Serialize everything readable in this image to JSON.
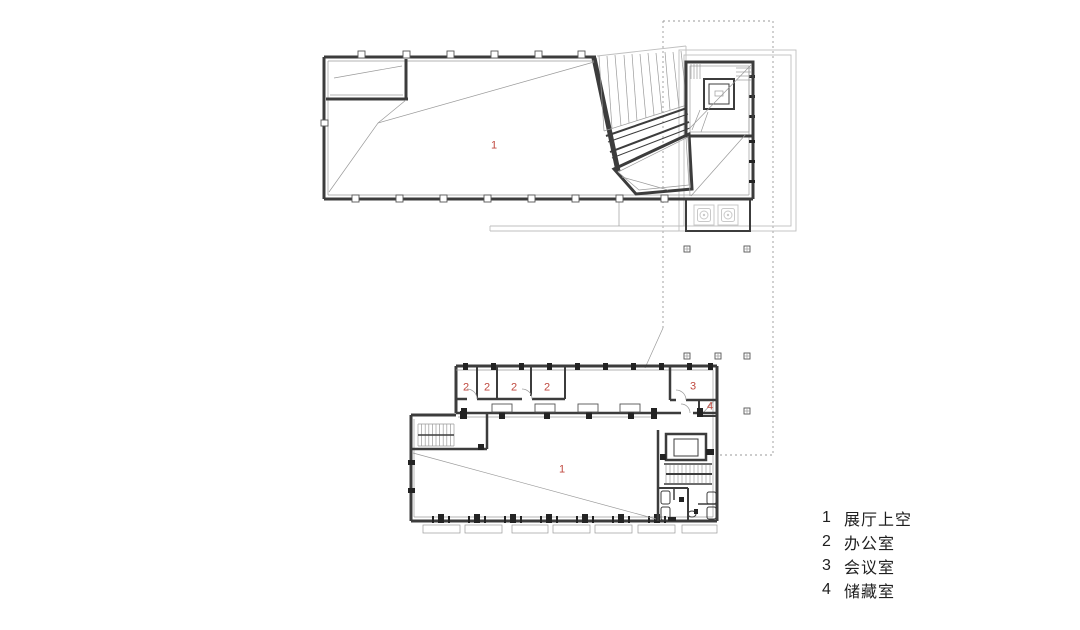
{
  "legend": {
    "items": [
      {
        "num": "1",
        "label": "展厅上空"
      },
      {
        "num": "2",
        "label": "办公室"
      },
      {
        "num": "3",
        "label": "会议室"
      },
      {
        "num": "4",
        "label": "储藏室"
      }
    ]
  },
  "room_numbers": {
    "exhibition_void": "1",
    "exhibition": "1",
    "office": "2",
    "meeting": "3",
    "storage": "4"
  },
  "colors": {
    "room_label": "#c04a40",
    "legend_text": "#1f1f1f",
    "wall_line": "#3c3c3c",
    "light_line": "#bfbfbf",
    "background": "#ffffff"
  }
}
